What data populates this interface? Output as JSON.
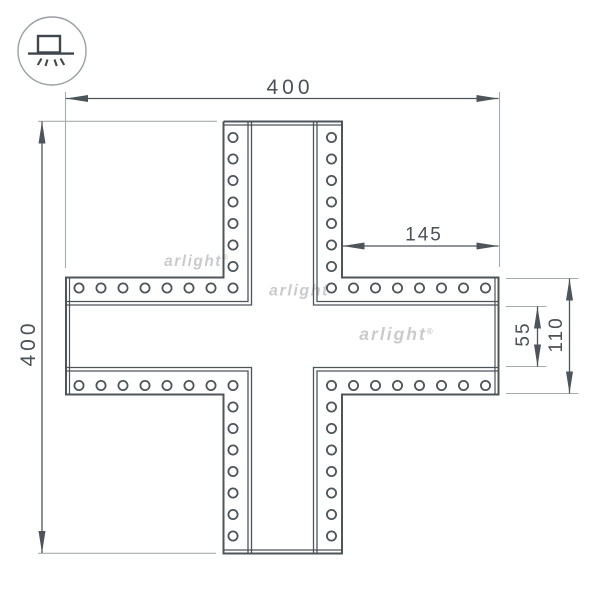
{
  "page": {
    "background": "#ffffff"
  },
  "logo": {
    "icon_name": "surface-mounted-light-icon",
    "circle": {
      "cx": 52,
      "cy": 51,
      "r": 34
    },
    "box": {
      "x": 38,
      "y": 36,
      "w": 22,
      "h": 16.5
    },
    "base": {
      "x1": 28,
      "x2": 74,
      "y": 53.6
    },
    "rays": [
      [
        41.5,
        58.5,
        37.8,
        65
      ],
      [
        47.5,
        59.5,
        45.5,
        66
      ],
      [
        54.5,
        59.5,
        56.8,
        66
      ],
      [
        60.5,
        58.5,
        64.2,
        65
      ]
    ]
  },
  "watermarks": [
    {
      "text": "arlight",
      "reg": "®",
      "x": 196,
      "y": 266,
      "size": 15.5,
      "ls": 1.5
    },
    {
      "text": "arlight",
      "reg": "®",
      "x": 302,
      "y": 295.5,
      "size": 16,
      "ls": 1.6
    },
    {
      "text": "arlight",
      "reg": "®",
      "x": 396,
      "y": 340,
      "size": 17.5,
      "ls": 2
    }
  ],
  "drawing": {
    "units": "mm",
    "outline": {
      "L": 66,
      "R": 498.5,
      "T": 121.5,
      "B": 553.5,
      "aL": 223.5,
      "aR": 342,
      "aT": 277.5,
      "aB": 394.5,
      "cap_inset": 3.5
    },
    "channel": {
      "x1": 251.5,
      "x2": 313.5,
      "y1": 305,
      "y2": 367.5,
      "off": 3.5
    },
    "holes": {
      "radius": 4.6,
      "columns_x": [
        233,
        331.5
      ],
      "rows_y": [
        288,
        385.5
      ],
      "col_top": {
        "start": 137.5,
        "step": 21.5,
        "count": 8
      },
      "col_bottom": {
        "start": 385.5,
        "step": 21.5,
        "count": 8
      },
      "row_left": {
        "start": 79,
        "step": 22,
        "count": 7
      },
      "row_right": {
        "start": 353.5,
        "step": 22,
        "count": 7
      }
    },
    "dimensions": [
      {
        "label": "400",
        "orient": "h",
        "line": {
          "x1": 66,
          "x2": 498.5,
          "y": 98.5
        },
        "text": {
          "x": 290,
          "y": 94,
          "size": 21,
          "ls": 4
        },
        "ext": [
          {
            "x": 65.5,
            "y1": 92,
            "y2": 268
          },
          {
            "x": 499.5,
            "y1": 92,
            "y2": 267
          }
        ]
      },
      {
        "label": "400",
        "orient": "v",
        "line": {
          "x": 42,
          "y1": 121.5,
          "y2": 553
        },
        "text": {
          "x": 35,
          "y": 343,
          "size": 21,
          "ls": 4
        },
        "ext": [
          {
            "y": 121.3,
            "x1": 38,
            "x2": 217
          },
          {
            "y": 553.3,
            "x1": 38,
            "x2": 216
          }
        ]
      },
      {
        "label": "145",
        "orient": "h",
        "line": {
          "x1": 342.5,
          "x2": 498.5,
          "y": 246
        },
        "text": {
          "x": 424,
          "y": 240.5,
          "size": 19,
          "ls": 2
        },
        "ext": []
      },
      {
        "label": "55",
        "orient": "v",
        "line": {
          "x": 537.5,
          "y1": 306.5,
          "y2": 366.5
        },
        "text": {
          "x": 529,
          "y": 334,
          "size": 19,
          "ls": 2
        },
        "ext": [
          {
            "y": 306.5,
            "x1": 506,
            "x2": 546.5
          },
          {
            "y": 366.5,
            "x1": 506,
            "x2": 546.5
          }
        ]
      },
      {
        "label": "110",
        "orient": "v",
        "line": {
          "x": 569.5,
          "y1": 278.5,
          "y2": 393.5
        },
        "text": {
          "x": 562,
          "y": 334.5,
          "size": 19,
          "ls": 2
        },
        "ext": [
          {
            "y": 278.5,
            "x1": 506,
            "x2": 578.5
          },
          {
            "y": 393.5,
            "x1": 506,
            "x2": 578.5
          }
        ]
      }
    ]
  }
}
